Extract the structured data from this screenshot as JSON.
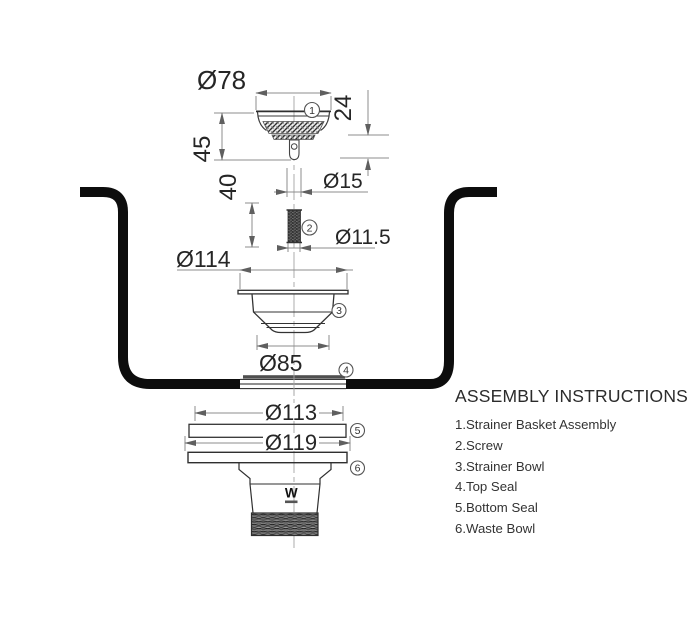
{
  "instructions": {
    "heading": "ASSEMBLY INSTRUCTIONS",
    "items": [
      "1.Strainer Basket Assembly",
      "2.Screw",
      "3.Strainer Bowl",
      "4.Top Seal",
      "5.Bottom Seal",
      "6.Waste Bowl"
    ]
  },
  "dimensions": {
    "basket_diameter": "Ø78",
    "basket_height": "45",
    "stem_height": "24",
    "screw_length": "40",
    "stem_diameter": "Ø15",
    "screw_diameter": "Ø11.5",
    "bowl_flange_diameter": "Ø114",
    "bowl_bottom_diameter": "Ø85",
    "bottom_seal_diameter": "Ø113",
    "waste_flange_diameter": "Ø119"
  },
  "callouts": {
    "c1": "1",
    "c2": "2",
    "c3": "3",
    "c4": "4",
    "c5": "5",
    "c6": "6"
  },
  "logo_text": "W",
  "colors": {
    "sink_outline": "#0d0d0d",
    "part_line": "#3a3a3a",
    "dimension_line": "#8c8c8c",
    "text": "#262626",
    "top_seal_fill": "#4f4f4f"
  }
}
